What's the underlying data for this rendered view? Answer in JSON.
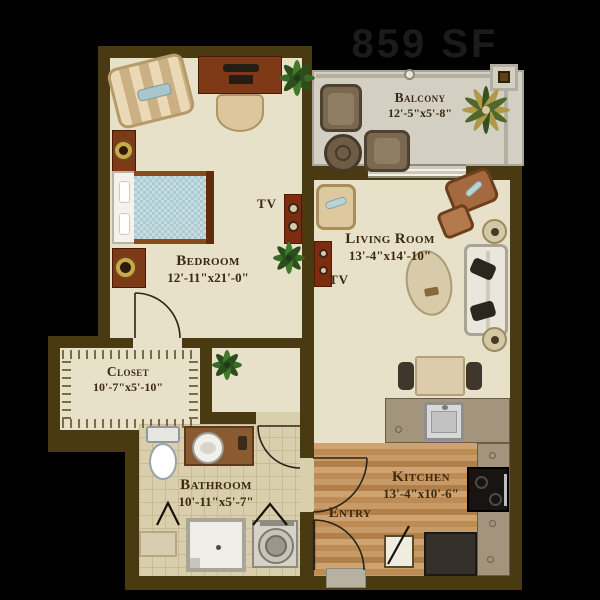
{
  "plan": {
    "area_label": "859 SF",
    "rooms": {
      "balcony": {
        "name": "Balcony",
        "dims": "12'-5\"x5'-8\""
      },
      "living_room": {
        "name": "Living Room",
        "dims": "13'-4\"x14'-10\""
      },
      "bedroom": {
        "name": "Bedroom",
        "dims": "12'-11\"x21'-0\""
      },
      "closet": {
        "name": "Closet",
        "dims": "10'-7\"x5'-10\""
      },
      "bathroom": {
        "name": "Bathroom",
        "dims": "10'-11\"x5'-7\""
      },
      "entry": {
        "name": "Entry"
      },
      "kitchen": {
        "name": "Kitchen",
        "dims": "13'-4\"x10'-6\""
      }
    },
    "annotations": {
      "tv_bedroom": "TV",
      "tv_living": "TV"
    },
    "colors": {
      "background": "#000000",
      "wall": "#4a3a12",
      "floor_cream": "#e6e1c8",
      "floor_balcony": "#d3cfc3",
      "floor_tile": "#dacfad",
      "floor_wood": "#c49764",
      "counter": "#a3947d",
      "bed_teal": "#a9cbd1",
      "label_text": "#3b2a11"
    }
  }
}
